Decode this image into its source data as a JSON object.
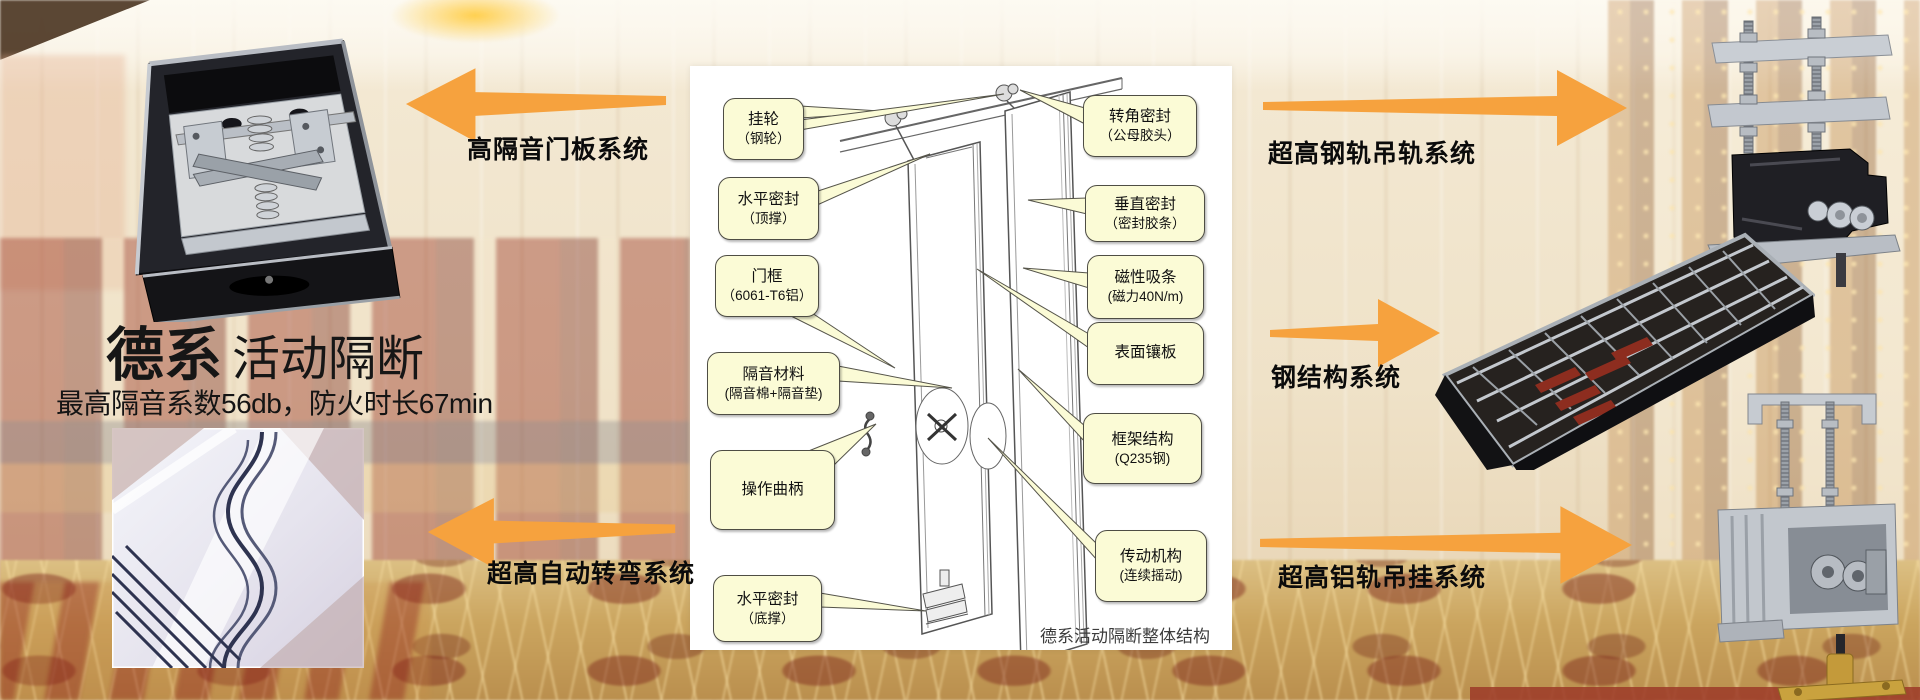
{
  "colors": {
    "arrow_orange": "#F6A23E",
    "callout_fill": "#FBFBD6",
    "callout_border": "#4E4D44",
    "background_cream": "#EFE3CB",
    "door_red": "#9A3626",
    "carpet_gold": "#C9A360",
    "panel_white": "#FFFFFF",
    "text_black": "#111111"
  },
  "hero": {
    "title_bold": "德系",
    "title_rest": "活动隔断",
    "subtitle": "最高隔音系数56db，防火时长67min"
  },
  "system_labels": {
    "left_top": "高隔音门板系统",
    "left_bottom": "超高自动转弯系统",
    "right_top": "超高钢轨吊轨系统",
    "right_middle": "钢结构系统",
    "right_bottom": "超高铝轨吊挂系统"
  },
  "diagram": {
    "caption": "德系活动隔断整体结构",
    "callouts_left": [
      {
        "line1": "挂轮",
        "line2": "（钢轮）"
      },
      {
        "line1": "水平密封",
        "line2": "（顶撑）"
      },
      {
        "line1": "门框",
        "line2": "（6061-T6铝）"
      },
      {
        "line1": "隔音材料",
        "line2": "(隔音棉+隔音垫)"
      },
      {
        "line1": "操作曲柄"
      },
      {
        "line1": "水平密封",
        "line2": "（底撑）"
      }
    ],
    "callouts_right": [
      {
        "line1": "转角密封",
        "line2": "（公母胶头）"
      },
      {
        "line1": "垂直密封",
        "line2": "（密封胶条）"
      },
      {
        "line1": "磁性吸条",
        "line2": "(磁力40N/m)"
      },
      {
        "line1": "表面镶板"
      },
      {
        "line1": "框架结构",
        "line2": "(Q235钢)"
      },
      {
        "line1": "传动机构",
        "line2": "(连续摇动)"
      }
    ]
  }
}
